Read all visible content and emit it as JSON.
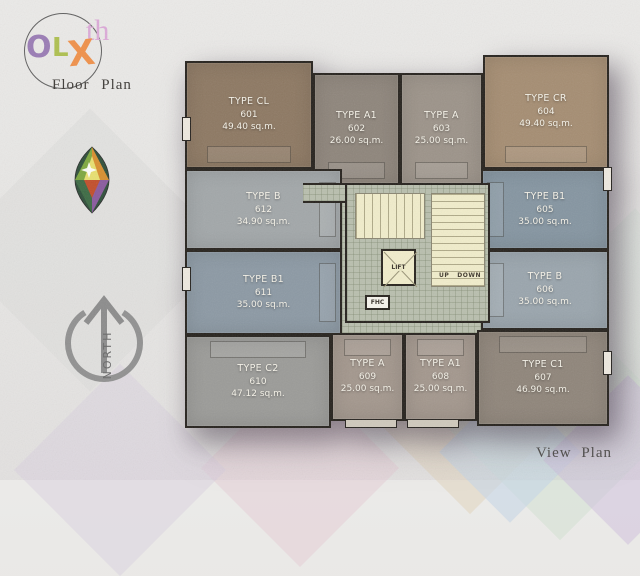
{
  "branding": {
    "logo": {
      "letters": [
        {
          "char": "O",
          "color": "#9a7cb5"
        },
        {
          "char": "L",
          "color": "#aec04f"
        },
        {
          "char": "X",
          "color": "#f0914a"
        }
      ],
      "suffix": "th",
      "suffix_color": "#dcaad8",
      "subtitle": "Floor Plan"
    },
    "icons": {
      "gem": "diamond-gem-icon",
      "compass": "north-arrow-icon"
    }
  },
  "compass": {
    "label": "NORTH"
  },
  "plan": {
    "units": [
      {
        "number": "601",
        "type": "TYPE CL",
        "area": "49.40 sq.m.",
        "color": "#8d7862"
      },
      {
        "number": "602",
        "type": "TYPE A1",
        "area": "26.00 sq.m.",
        "color": "#8e857b"
      },
      {
        "number": "603",
        "type": "TYPE A",
        "area": "25.00 sq.m.",
        "color": "#9c9389"
      },
      {
        "number": "604",
        "type": "TYPE CR",
        "area": "49.40 sq.m.",
        "color": "#a58d72"
      },
      {
        "number": "605",
        "type": "TYPE B1",
        "area": "35.00 sq.m.",
        "color": "#8595a1"
      },
      {
        "number": "606",
        "type": "TYPE B",
        "area": "35.00 sq.m.",
        "color": "#9aa5ad"
      },
      {
        "number": "607",
        "type": "TYPE C1",
        "area": "46.90 sq.m.",
        "color": "#8f857a"
      },
      {
        "number": "608",
        "type": "TYPE A1",
        "area": "25.00 sq.m.",
        "color": "#a3978d"
      },
      {
        "number": "609",
        "type": "TYPE A",
        "area": "25.00 sq.m.",
        "color": "#a3978d"
      },
      {
        "number": "610",
        "type": "TYPE C2",
        "area": "47.12 sq.m.",
        "color": "#9b9b98"
      },
      {
        "number": "611",
        "type": "TYPE B1",
        "area": "35.00 sq.m.",
        "color": "#8c99a4"
      },
      {
        "number": "612",
        "type": "TYPE B",
        "area": "34.90 sq.m.",
        "color": "#a2a7a9"
      }
    ],
    "core": {
      "lift": "LIFT",
      "up": "UP",
      "down": "DOWN",
      "fhc": "FHC"
    }
  },
  "footer": {
    "view_plan": "View Plan"
  }
}
